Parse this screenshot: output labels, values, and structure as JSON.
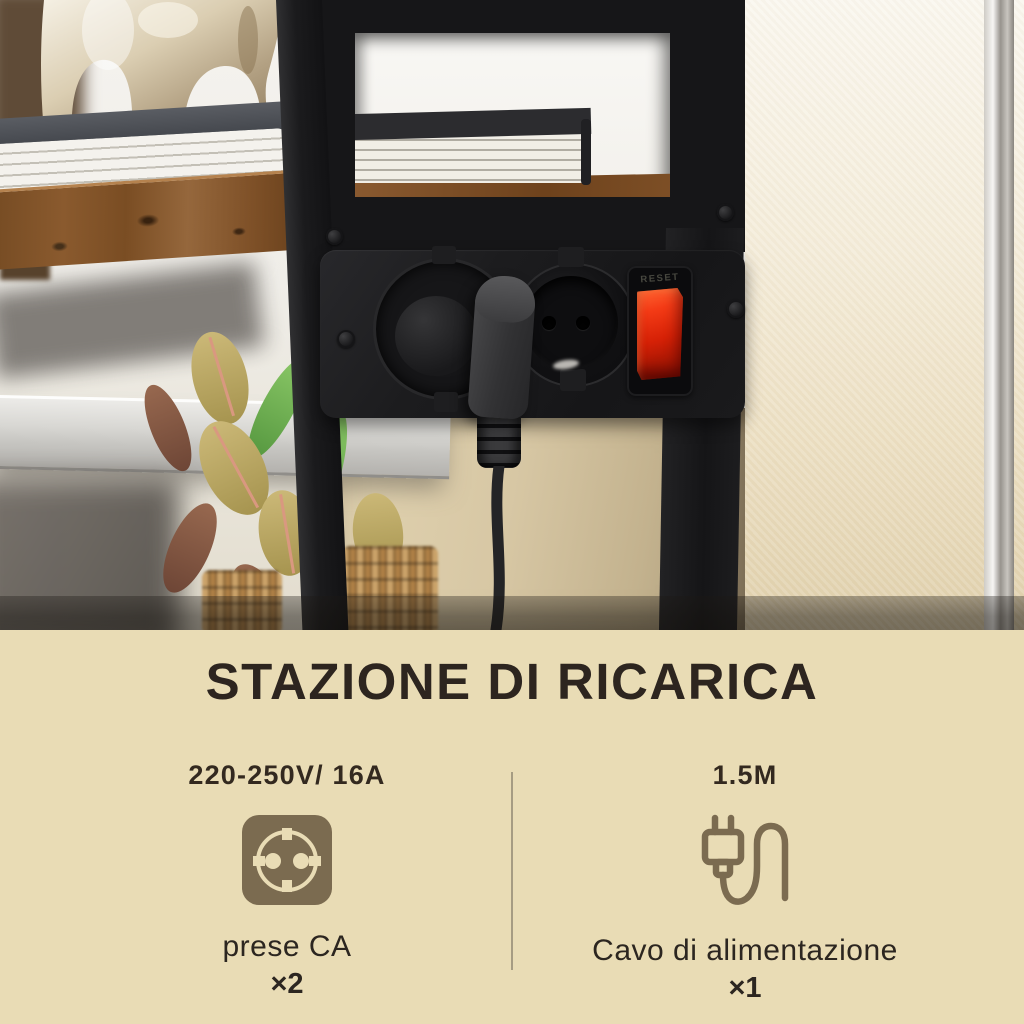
{
  "photo": {
    "switch_label": "RESET",
    "icons": [
      "ceramic-vase",
      "books",
      "wood-shelf",
      "glass-shelf",
      "rubber-plant",
      "woven-basket",
      "power-strip",
      "schuko-socket",
      "power-plug",
      "power-cable",
      "reset-switch"
    ],
    "colors": {
      "frame_black": "#1a1a1c",
      "switch_red": "#e62c0d",
      "wood_brown": "#82542a",
      "wall_cream": "#f0e8d4"
    }
  },
  "info_panel": {
    "title": "STAZIONE DI RICARICA",
    "background": "#e9dcb5",
    "text_color": "#2d251f",
    "icon_color": "#7b6b50",
    "divider_color": "#a69c82",
    "columns": [
      {
        "spec": "220-250V/ 16A",
        "icon": "schuko-outlet-icon",
        "label": "prese CA",
        "count": "×2"
      },
      {
        "spec": "1.5M",
        "icon": "power-cord-icon",
        "label": "Cavo di alimentazione",
        "count": "×1"
      }
    ]
  }
}
